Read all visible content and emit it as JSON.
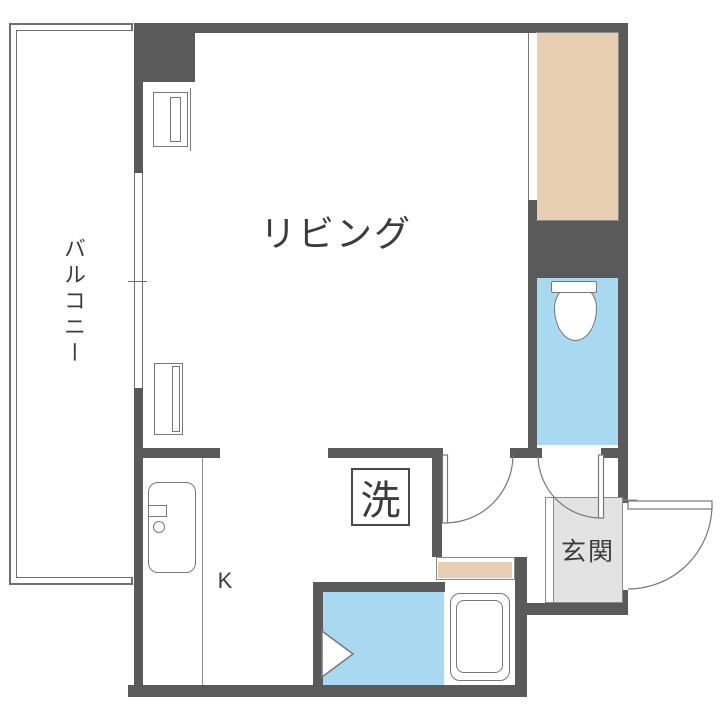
{
  "title": "1R apartment floor plan",
  "labels": {
    "living": "リビング",
    "balcony": "バルコニー",
    "kitchen": "K",
    "washer": "洗",
    "entrance": "玄関"
  },
  "colors": {
    "background": "#ffffff",
    "wall": "#5a5a5a",
    "water_blue": "#a9d9f1",
    "closet_beige": "#e8cfb2",
    "genkan_gray": "#e3e3e3",
    "outline": "#8a8a8a",
    "line_mid": "#777777",
    "line_dark": "#6f6f6f",
    "line_darkest": "#4a4a4a",
    "text": "#3c3c3c"
  }
}
